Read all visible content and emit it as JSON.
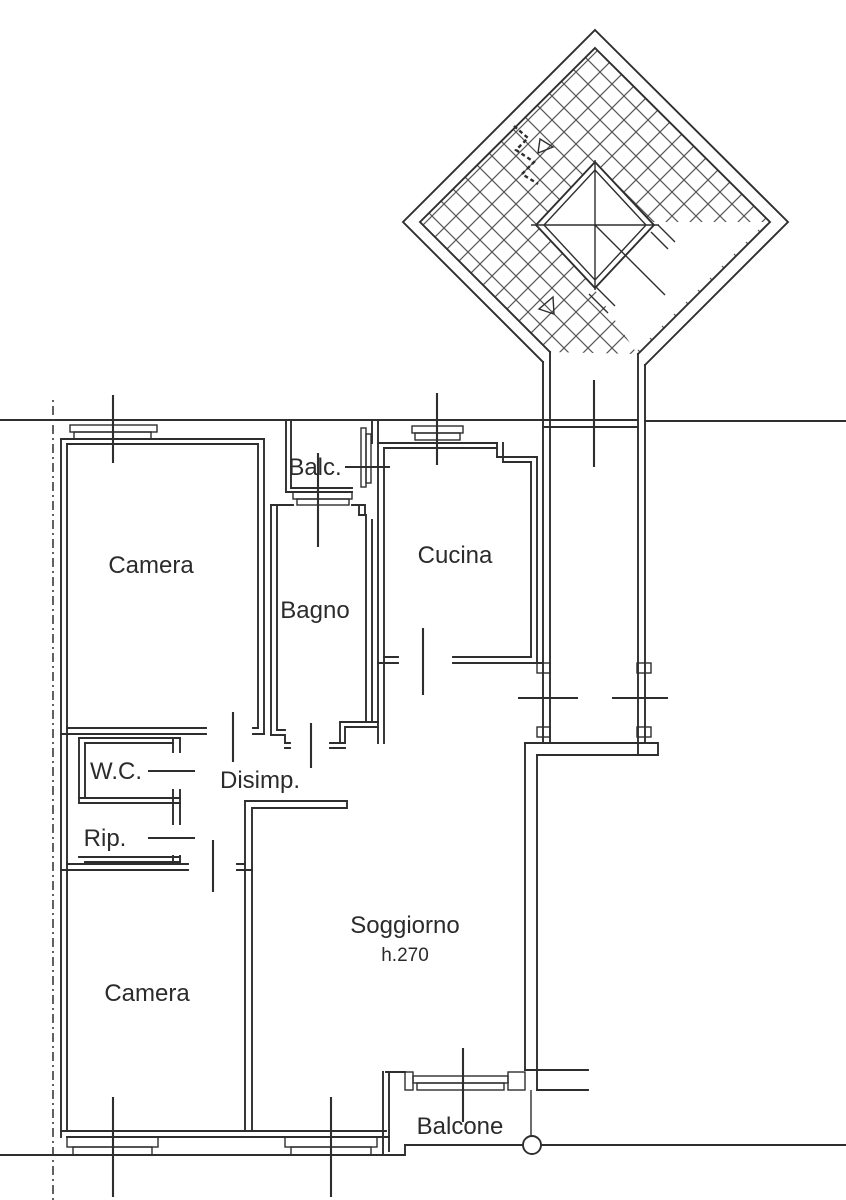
{
  "rooms": {
    "camera_top": {
      "label": "Camera"
    },
    "balc": {
      "label": "Balc."
    },
    "bagno": {
      "label": "Bagno"
    },
    "cucina": {
      "label": "Cucina"
    },
    "wc": {
      "label": "W.C."
    },
    "rip": {
      "label": "Rip."
    },
    "disimp": {
      "label": "Disimp."
    },
    "soggiorno": {
      "label": "Soggiorno",
      "height_note": "h.270"
    },
    "camera_bottom": {
      "label": "Camera"
    },
    "balcone": {
      "label": "Balcone"
    }
  },
  "colors": {
    "line": "#2e2e2e",
    "stair_hatch": "#555555",
    "text": "#2b2b2b",
    "background": "#ffffff"
  },
  "icons": {
    "stair_direction_arrow": "up-arrow-zigzag",
    "stair_start_arrow": "triangle-arrow",
    "balcony_column": "circle-column"
  }
}
